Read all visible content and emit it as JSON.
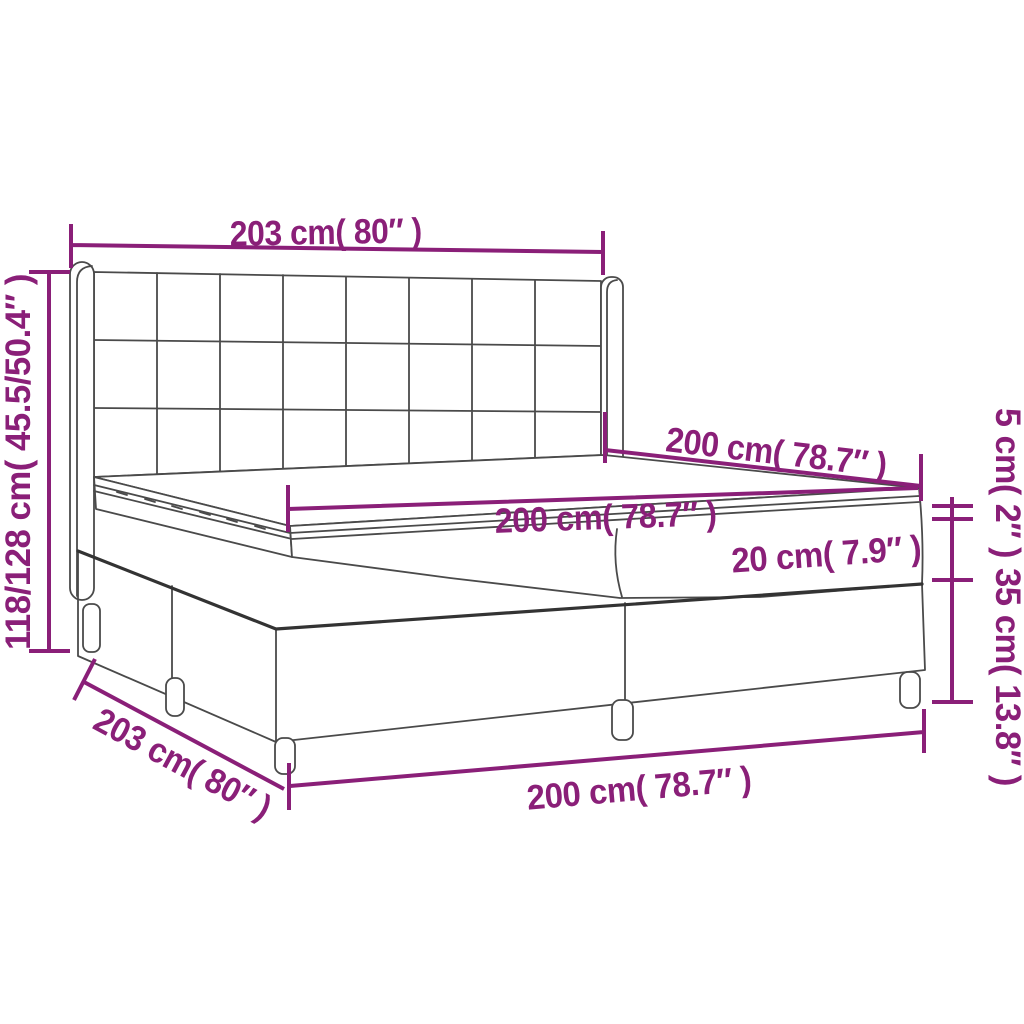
{
  "diagram": {
    "type": "product-dimension-diagram",
    "product": "box spring bed with tufted headboard, two-piece base, mattress and topper",
    "background": "#ffffff",
    "colors": {
      "dimension": "#8a1f78",
      "outline": "#4a4a4a",
      "shadow": "#333333"
    },
    "labels": {
      "headboard_width": "203 cm( 80″ )",
      "total_height": "118/128 cm( 45.5/50.4″ )",
      "mattress_length": "200 cm( 78.7″ )",
      "mattress_width": "200 cm( 78.7″ )",
      "mattress_height": "20 cm( 7.9″ )",
      "topper_height": "5 cm( 2″ )",
      "box_height": "35 cm( 13.8″ )",
      "base_side_length": "203 cm( 80″ )",
      "base_front_width": "200 cm( 78.7″ )"
    }
  }
}
